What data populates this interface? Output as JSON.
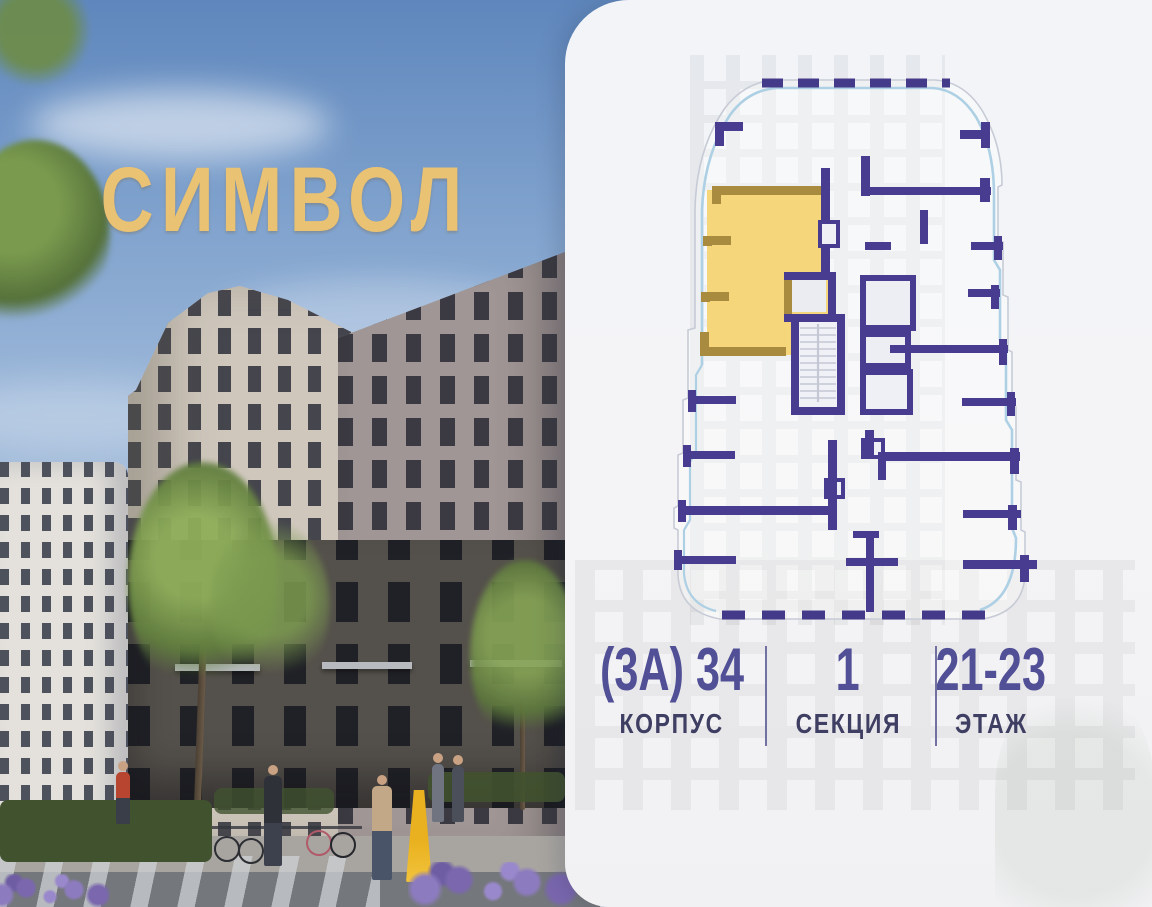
{
  "logo": {
    "text": "СИМВОЛ",
    "color": "#e9c273"
  },
  "info": {
    "corpus": {
      "value": "(3А) 34",
      "label": "КОРПУС"
    },
    "section": {
      "value": "1",
      "label": "СЕКЦИЯ"
    },
    "floor": {
      "value": "21-23",
      "label": "ЭТАЖ"
    },
    "value_color": "#514f96",
    "label_color": "#3f3e63"
  },
  "floorplan": {
    "wall_color": "#473c8f",
    "highlight_fill": "#f6d67a",
    "highlight_wall_color": "#a88b3e",
    "glazing_line_color": "#aed0e4",
    "outline_color": "#c7cbd6",
    "highlighted_apartment": "corner apartment upper-left"
  }
}
